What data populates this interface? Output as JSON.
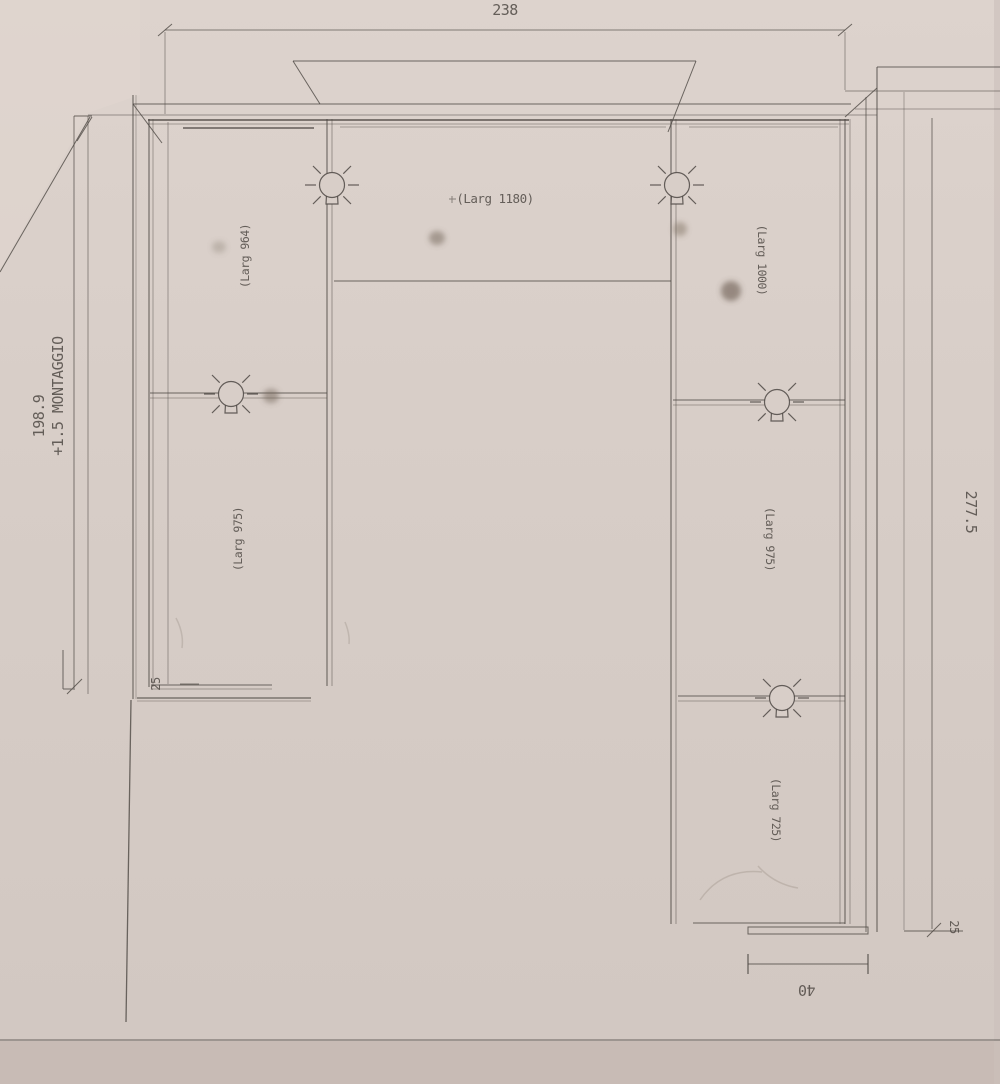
{
  "drawing": {
    "description": "photographed cabinet installation technical drawing",
    "dimensions": {
      "total_width": "238",
      "left_height": "198.9",
      "left_note": "+1.5 MONTAGGIO",
      "right_height": "277.5",
      "filler_left": "25",
      "filler_right": "25",
      "bottom_width": "40"
    },
    "cabinets": {
      "left_top": "(Larg 964)",
      "top_center": "(Larg 1180)",
      "right_top": "(Larg 1000)",
      "left_mid": "(Larg 975)",
      "right_mid": "(Larg 975)",
      "right_bottom": "(Larg 725)"
    },
    "symbols": {
      "light_symbol_count": 5
    },
    "colors": {
      "paper": "#d8cec8",
      "paper_dark": "#c8bbb5",
      "line": "#4e4844",
      "text": "#544e49"
    }
  }
}
